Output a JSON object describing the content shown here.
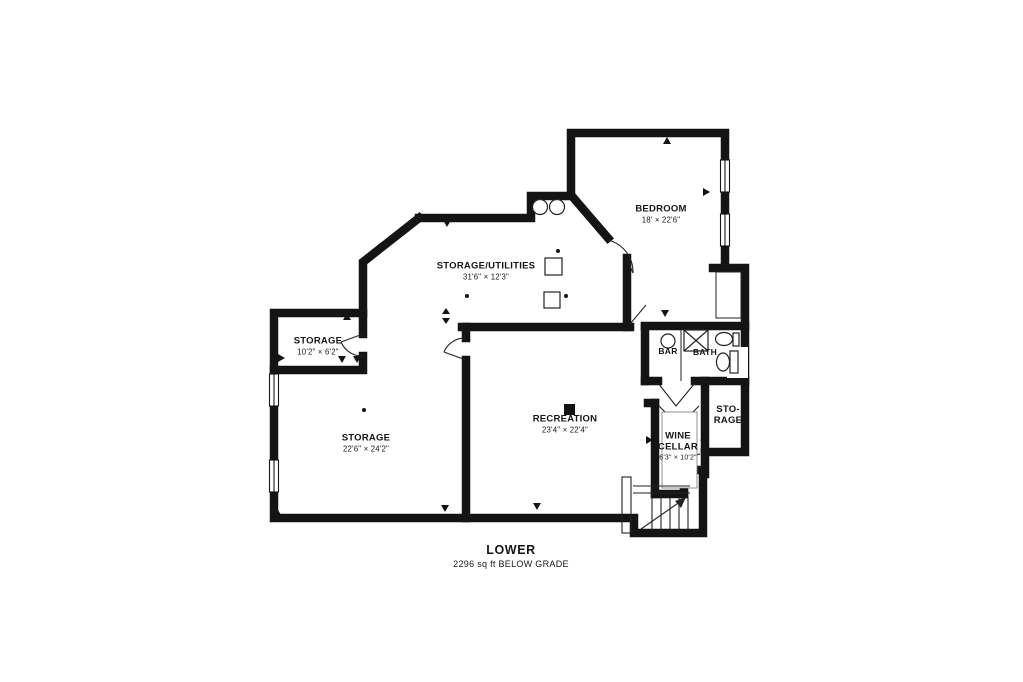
{
  "floor_plan": {
    "rooms": [
      {
        "id": "bedroom",
        "name": "BEDROOM",
        "dims": "18' × 22'6\""
      },
      {
        "id": "storage-utilities",
        "name": "STORAGE/UTILITIES",
        "dims": "31'6\" × 12'3\""
      },
      {
        "id": "storage-small",
        "name": "STORAGE",
        "dims": "10'2\" × 6'2\""
      },
      {
        "id": "storage-large",
        "name": "STORAGE",
        "dims": "22'6\" × 24'2\""
      },
      {
        "id": "recreation",
        "name": "RECREATION",
        "dims": "23'4\" × 22'4\""
      },
      {
        "id": "bar",
        "name": "BAR",
        "dims": ""
      },
      {
        "id": "bath",
        "name": "BATH",
        "dims": ""
      },
      {
        "id": "wine-cellar",
        "name": "WINE CELLAR",
        "dims": "6'3\" × 10'2\""
      },
      {
        "id": "storage-side",
        "name": "STO-RAGE",
        "dims": ""
      }
    ],
    "footer": {
      "title": "LOWER",
      "subtitle": "2296 sq ft BELOW GRADE"
    },
    "colors": {
      "wall": "#141414",
      "background": "#ffffff"
    }
  }
}
